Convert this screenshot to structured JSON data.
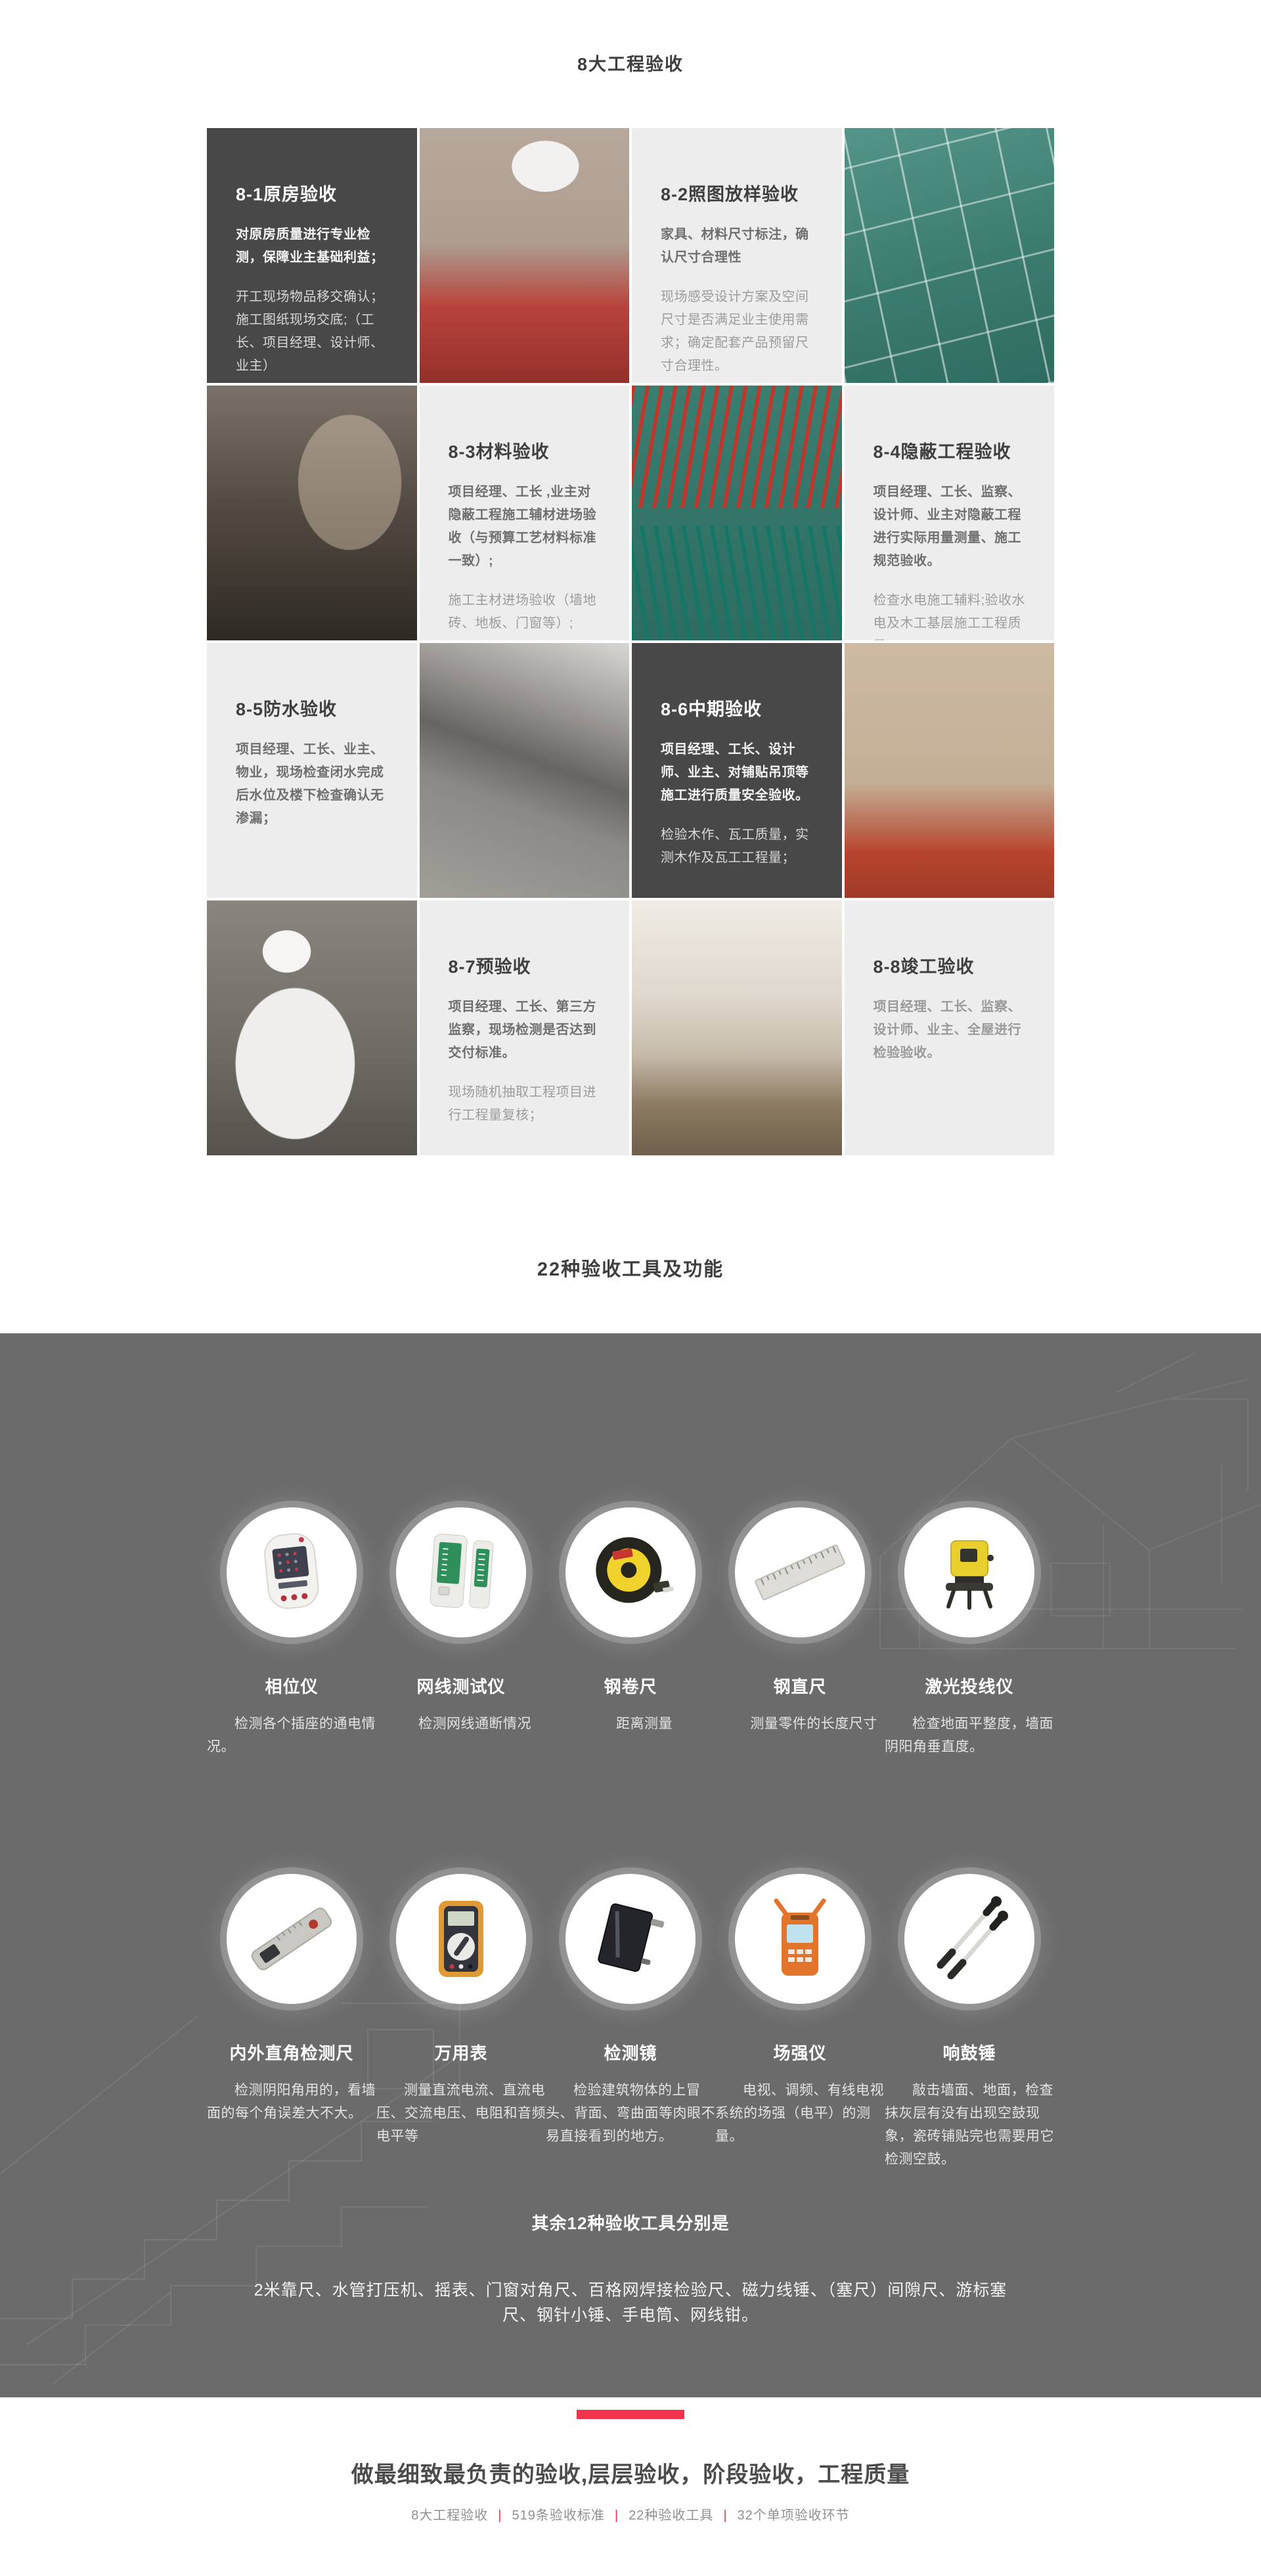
{
  "page": {
    "section1_title": "8大工程验收",
    "section2_title": "22种验收工具及功能"
  },
  "cards": [
    {
      "title": "8-1原房验收",
      "strong": "对原房质量进行专业检测，保障业主基础利益；",
      "normal": "开工现场物品移交确认；\n施工图纸现场交底;（工长、项目经理、设计师、业主）",
      "theme": "dark"
    },
    {
      "title": "8-2照图放样验收",
      "strong": "家具、材料尺寸标注，确认尺寸合理性",
      "normal": "现场感受设计方案及空间尺寸是否满足业主使用需求；确定配套产品预留尺寸合理性。",
      "theme": "light"
    },
    {
      "title": "8-3材料验收",
      "strong": "项目经理、工长 ,业主对隐蔽工程施工辅材进场验收（与预算工艺材料标准一致）;",
      "normal": "施工主材进场验收（墙地砖、地板、门窗等）;",
      "theme": "light"
    },
    {
      "title": "8-4隐蔽工程验收",
      "strong": "项目经理、工长、监察、设计师、业主对隐蔽工程进行实际用量测量、施工规范验收。",
      "normal": "检查水电施工辅料;验收水电及木工基层施工工程质量；\n实测隐蔽工程的工程量，第三方监察专人全程监督记录；",
      "theme": "light"
    },
    {
      "title": "8-5防水验收",
      "strong": "项目经理、工长、业主、物业，现场检查闭水完成后水位及楼下检查确认无渗漏；",
      "normal": "",
      "theme": "light"
    },
    {
      "title": "8-6中期验收",
      "strong": "项目经理、工长、设计师、业主、对铺贴吊顶等施工进行质量安全验收。",
      "normal": "检验木作、瓦工质量，实测木作及瓦工工程量；",
      "theme": "dark"
    },
    {
      "title": "8-7预验收",
      "strong": "项目经理、工长、第三方监察，现场检测是否达到交付标准。",
      "normal": "现场随机抽取工程项目进行工程量复核；",
      "theme": "light"
    },
    {
      "title": "8-8竣工验收",
      "strong": "项目经理、工长、监察、设计师、业主、全屋进行检验验收。",
      "normal": "",
      "theme": "light"
    }
  ],
  "photos": {
    "p1": "worker-in-red-shirt-testing-socket",
    "p2": "green-floor-with-layout-chalk-lines",
    "p3": "dark-room-under-renovation",
    "p4": "red-and-green-pipes-on-floor",
    "p5": "waterproofed-corner-gray",
    "p6": "bathroom-tiles-with-red-protection",
    "p7": "inspector-in-white-shirt",
    "p8": "finished-bright-interior"
  },
  "tools": {
    "row1": [
      {
        "name": "相位仪",
        "desc": "检测各个插座的通电情况。",
        "icon": "phase-tester-icon"
      },
      {
        "name": "网线测试仪",
        "desc": "检测网线通断情况",
        "icon": "cable-tester-icon"
      },
      {
        "name": "钢卷尺",
        "desc": "距离测量",
        "icon": "tape-measure-icon"
      },
      {
        "name": "钢直尺",
        "desc": "测量零件的长度尺寸",
        "icon": "steel-ruler-icon"
      },
      {
        "name": "激光投线仪",
        "desc": "检查地面平整度，墙面阴阳角垂直度。",
        "icon": "laser-level-icon"
      }
    ],
    "row2": [
      {
        "name": "内外直角检测尺",
        "desc": "检测阴阳角用的，看墙面的每个角误差大不大。",
        "icon": "angle-ruler-icon"
      },
      {
        "name": "万用表",
        "desc": "测量直流电流、直流电压、交流电压、电阻和音频电平等",
        "icon": "multimeter-icon"
      },
      {
        "name": "检测镜",
        "desc": "检验建筑物体的上冒头、背面、弯曲面等肉眼不易直接看到的地方。",
        "icon": "inspection-mirror-icon"
      },
      {
        "name": "场强仪",
        "desc": "电视、调频、有线电视系统的场强（电平）的测量。",
        "icon": "field-strength-meter-icon"
      },
      {
        "name": "响鼓锤",
        "desc": "敲击墙面、地面，检查抹灰层有没有出现空鼓现象，瓷砖铺贴完也需要用它检测空鼓。",
        "icon": "percussion-hammer-icon"
      }
    ],
    "others_title": "其余12种验收工具分别是",
    "others_list": "2米靠尺、水管打压机、摇表、门窗对角尺、百格网焊接检验尺、磁力线锤、（塞尺）间隙尺、游标塞尺、钢针小锤、手电筒、网线钳。"
  },
  "footer": {
    "slogan": "做最细致最负责的验收,层层验收，阶段验收，工程质量",
    "separator": "|",
    "links": [
      "8大工程验收",
      "519条验收标准",
      "22种验收工具",
      "32个单项验收环节"
    ]
  },
  "colors": {
    "accent": "#f2334c",
    "dark_panel": "#484848",
    "light_panel": "#ededed",
    "tools_background": "#6b6b6b",
    "title_text": "#3e3e3e"
  }
}
